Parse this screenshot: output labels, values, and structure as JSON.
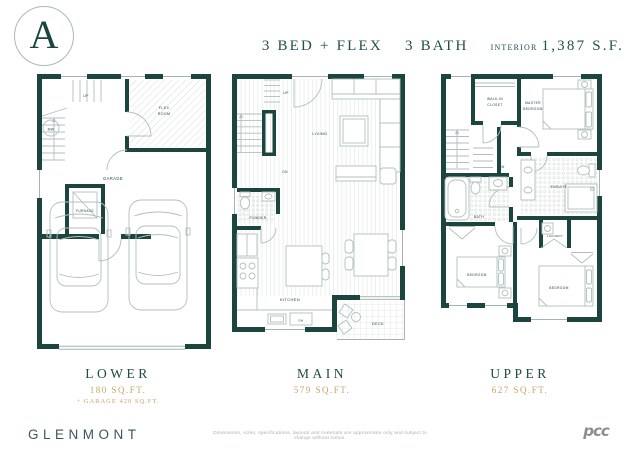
{
  "header": {
    "unit_letter": "A",
    "beds": "3 BED + FLEX",
    "baths": "3 BATH",
    "interior_label": "INTERIOR",
    "interior_area": "1,387 S.F."
  },
  "plans": {
    "lower": {
      "title": "LOWER",
      "area": "180 SQ.FT.",
      "area_note": "+ GARAGE 420 SQ.FT.",
      "labels": {
        "up": "UP",
        "mw": "MW",
        "furnace": "FURNACE",
        "flex1": "FLEX",
        "flex2": "ROOM",
        "garage": "GARAGE"
      }
    },
    "main": {
      "title": "MAIN",
      "area": "579 SQ.FT.",
      "labels": {
        "up": "UP",
        "dn": "DN",
        "living": "LIVING",
        "powder": "POWDER",
        "kitchen": "KITCHEN",
        "dw": "DW",
        "deck": "DECK"
      }
    },
    "upper": {
      "title": "UPPER",
      "area": "627 SQ.FT.",
      "labels": {
        "walkin1": "WALK-IN",
        "walkin2": "CLOSET",
        "master1": "MASTER",
        "master2": "BEDROOM",
        "dn": "DN",
        "bath": "BATH",
        "ensuite": "ENSUITE",
        "laundry": "LAUNDRY",
        "bedroom_left": "BEDROOM",
        "bedroom_right": "BEDROOM"
      }
    }
  },
  "footer": {
    "brand": "GLENMONT",
    "disclaimer": "Dimensions, sizes, specifications, layouts and materials are approximate only and subject to change without notice.",
    "logo_text": "pcc"
  },
  "colors": {
    "wall_teal": "#1c4540",
    "accent_gold": "#c9a466",
    "brand_slate": "#3a565e",
    "furniture_line": "#b2bfbc",
    "logo_gray": "#8c8e8f"
  }
}
